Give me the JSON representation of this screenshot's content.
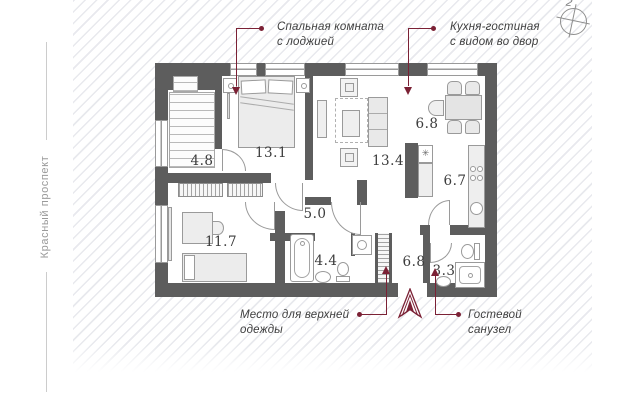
{
  "street_label": "Красный проспект",
  "compass": {
    "label": "2"
  },
  "rooms": {
    "stairs_hall": "4.8",
    "bedroom": "13.1",
    "living_room": "13.4",
    "dining": "6.8",
    "kitchen": "6.7",
    "hallway": "5.0",
    "bedroom_2": "11.7",
    "bathroom": "4.4",
    "entry_hall": "6.8",
    "guest_bathroom": "3.3"
  },
  "annotations": {
    "bedroom": {
      "line1": "Спальная комната",
      "line2": "с лоджией"
    },
    "kitchen": {
      "line1": "Кухня-гостиная",
      "line2": "с видом во двор"
    },
    "wardrobe": {
      "line1": "Место для верхней",
      "line2": "одежды"
    },
    "guest_wc": {
      "line1": "Гостевой",
      "line2": "санузел"
    }
  },
  "symbols": {
    "fridge_mark": "✳"
  },
  "colors": {
    "wall": "#5d5d5d",
    "accent": "#7b2135",
    "furniture_outline": "#9a9a9a",
    "hatch_line": "#cbced8"
  }
}
